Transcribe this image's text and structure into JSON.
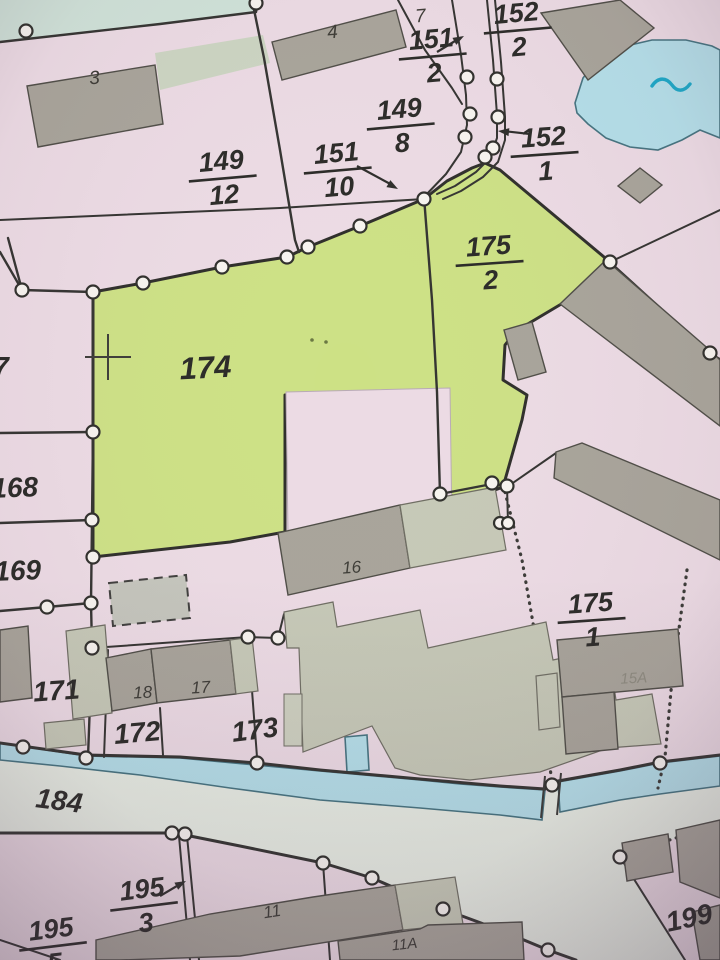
{
  "map": {
    "type": "cadastral-parcel-map-photo",
    "colors": {
      "pink": "#ecdbe4",
      "green": "#cde185",
      "teal": "#cfe2d8",
      "road": "#e8eee4",
      "water": "#b4dfe9",
      "wateraccent": "#1ba7c6",
      "bdark": "#a8a49a",
      "blight": "#c6c9b7",
      "boundary": "#333330",
      "ink": "#2a2a27",
      "point": "#f7f4ef"
    },
    "labels": {
      "building_3": "3",
      "building_4": "4",
      "parcel_7_top": "7",
      "parcel_7_left": "7",
      "parcel_149_12": {
        "num": "149",
        "den": "12"
      },
      "parcel_151_2": {
        "num": "151",
        "den": "2"
      },
      "parcel_152_2": {
        "num": "152",
        "den": "2"
      },
      "parcel_149_8": {
        "num": "149",
        "den": "8"
      },
      "parcel_151_10": {
        "num": "151",
        "den": "10"
      },
      "parcel_152_1": {
        "num": "152",
        "den": "1"
      },
      "parcel_175_2": {
        "num": "175",
        "den": "2"
      },
      "parcel_175_1": {
        "num": "175",
        "den": "1"
      },
      "parcel_195_3": {
        "num": "195",
        "den": "3"
      },
      "parcel_195_5": {
        "num": "195",
        "den": "5"
      },
      "parcel_174": "174",
      "parcel_168": "168",
      "parcel_169": "169",
      "parcel_171": "171",
      "parcel_172": "172",
      "parcel_173": "173",
      "parcel_184": "184",
      "parcel_199": "199",
      "building_16": "16",
      "building_17": "17",
      "building_18": "18",
      "building_15A": "15A",
      "building_11": "11",
      "building_11A": "11A"
    }
  }
}
